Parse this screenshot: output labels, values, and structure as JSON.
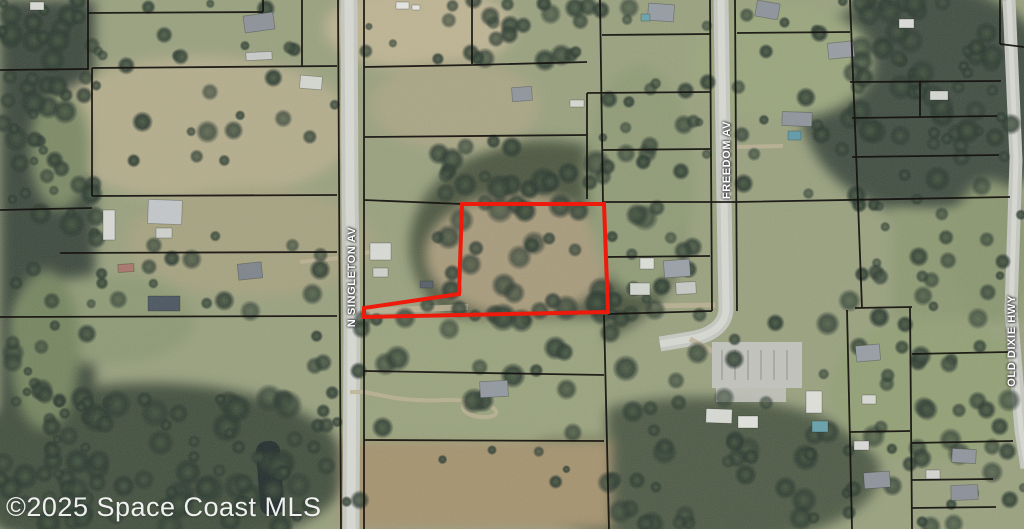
{
  "map": {
    "watermark": "©2025 Space Coast MLS",
    "roads": [
      {
        "name": "N SINGLETON AV",
        "label_x": 352,
        "label_y": 277
      },
      {
        "name": "FREEDOM AV",
        "label_x": 727,
        "label_y": 160
      },
      {
        "name": "OLD DIXIE HWY",
        "label_x": 1012,
        "label_y": 341
      }
    ],
    "colors": {
      "boundary": "#161310",
      "subject_outline": "#ee1a0b",
      "road_fill": "#c6c8c1",
      "road_core": "#d7d9d2",
      "dirt_path": "#bdb294",
      "label_text": "#ffffff",
      "watermark_text": "#ffffff",
      "base_terrain": "#99a17e"
    },
    "subject_parcel": {
      "outline_color": "#ee1a0b",
      "stroke_width": 4,
      "points": [
        [
          462,
          204
        ],
        [
          604,
          204
        ],
        [
          608,
          312
        ],
        [
          364,
          317
        ],
        [
          364,
          308
        ],
        [
          459,
          294
        ]
      ]
    },
    "road_strips": [
      {
        "d": "M349,0 L350,200 L352,330 L351,529",
        "w": 17
      },
      {
        "d": "M721,0 L724,200 L726,308 C726,326 710,336 690,339 L660,344",
        "w": 15
      },
      {
        "d": "M1009,0 L1016,160 L1011,310 L1021,430 L1027,468",
        "w": 13
      }
    ],
    "parcel_lines": [
      "M0,70 L88,69",
      "M88,0 L88,70",
      "M88,13 L263,12",
      "M263,0 L263,12",
      "M0,210 L92,208",
      "M92,68 L337,66",
      "M302,0 L302,66",
      "M92,68 L92,196",
      "M92,196 L337,195",
      "M60,253 L337,252",
      "M0,317 L337,316",
      "M338,0 L341,529",
      "M364,0 L364,529",
      "M364,67 L472,65 L587,62",
      "M472,0 L472,64",
      "M364,137 L587,135",
      "M587,93 L587,199",
      "M587,93 L710,92",
      "M600,0 L603,203",
      "M602,35 L710,34",
      "M602,150 L710,149",
      "M364,200 L462,204",
      "M462,204 L604,203",
      "M604,202 L735,202 L1010,197",
      "M606,257 L710,256",
      "M608,314 L712,311",
      "M604,315 L609,529",
      "M364,371 L604,375",
      "M364,440 L604,441",
      "M710,0 L712,311",
      "M735,0 L737,311",
      "M737,33 L850,32",
      "M850,0 L858,202 L862,308",
      "M847,310 L852,529",
      "M850,82 L1001,81",
      "M920,82 L920,117",
      "M852,118 L997,116",
      "M852,157 L999,155",
      "M1000,0 L1000,44",
      "M1000,44 L1024,47",
      "M855,308 L912,307",
      "M910,307 L912,529",
      "M912,354 L1008,352",
      "M850,432 L910,431",
      "M912,443 L1013,441",
      "M912,480 L993,479",
      "M912,508 L996,507"
    ],
    "fields": [
      [
        "r",
        0,
        0,
        95,
        529,
        "#3d4a3d"
      ],
      [
        "e",
        150,
        468,
        200,
        85,
        "#43503e"
      ],
      [
        "e",
        545,
        245,
        135,
        105,
        "#4b5741"
      ],
      [
        "e",
        930,
        100,
        130,
        115,
        "#404d40"
      ],
      [
        "e",
        700,
        472,
        180,
        75,
        "#4d5a44"
      ],
      [
        "e",
        200,
        128,
        155,
        72,
        "#b4ad8c"
      ],
      [
        "e",
        420,
        28,
        95,
        42,
        "#beb493"
      ],
      [
        "r",
        340,
        438,
        272,
        91,
        "#a5936e"
      ],
      [
        "r",
        337,
        317,
        270,
        122,
        "#9aa37d"
      ],
      [
        "e",
        782,
        62,
        92,
        58,
        "#9aa67d"
      ],
      [
        "e",
        930,
        390,
        100,
        72,
        "#92a074"
      ],
      [
        "e",
        520,
        255,
        95,
        62,
        "#a89b7c"
      ],
      [
        "e",
        640,
        180,
        55,
        115,
        "#909b76"
      ],
      [
        "r",
        892,
        208,
        132,
        112,
        "#8d9972"
      ],
      [
        "e",
        250,
        242,
        125,
        55,
        "#a5a380"
      ],
      [
        "e",
        455,
        105,
        85,
        45,
        "#a9a584"
      ],
      [
        "e",
        105,
        320,
        90,
        45,
        "#8e9a74"
      ],
      [
        "e",
        60,
        150,
        30,
        60,
        "#7c8a65"
      ],
      [
        "e",
        45,
        350,
        35,
        80,
        "#75855f"
      ],
      [
        "e",
        990,
        250,
        40,
        70,
        "#8a9770"
      ]
    ],
    "dirt_paths": [
      [
        "M364,311 L468,307",
        6
      ],
      [
        "M364,253 L372,252 L382,258",
        4
      ],
      [
        "M300,262 L338,258",
        4
      ],
      [
        "M350,392 L364,392 L395,398 C430,403 450,398 468,401",
        4
      ],
      [
        "M468,401 C500,404 505,418 482,417 C462,416 458,404 468,401",
        4
      ],
      [
        "M737,147 L783,146",
        4
      ],
      [
        "M652,306 L715,305",
        5
      ],
      [
        "M690,339 L714,352",
        5
      ]
    ],
    "parking_lot": {
      "x": 712,
      "y": 342,
      "w": 90,
      "h": 46,
      "fill": "#c2c3bd",
      "apron_x": 716,
      "apron_y": 386,
      "apron_w": 70,
      "apron_h": 16,
      "row_color": "#8e8f89"
    },
    "ponds": [
      [
        258,
        441,
        24,
        74,
        -4,
        "#222d2d"
      ]
    ],
    "tree_clusters": [
      [
        0,
        0,
        95,
        529,
        100,
        5,
        14
      ],
      [
        40,
        395,
        260,
        134,
        55,
        6,
        16
      ],
      [
        95,
        0,
        215,
        66,
        12,
        4,
        10
      ],
      [
        95,
        70,
        240,
        120,
        14,
        5,
        12
      ],
      [
        95,
        195,
        245,
        120,
        18,
        5,
        12
      ],
      [
        290,
        317,
        78,
        212,
        16,
        5,
        11
      ],
      [
        365,
        0,
        105,
        65,
        6,
        4,
        9
      ],
      [
        470,
        0,
        120,
        62,
        20,
        6,
        12
      ],
      [
        425,
        140,
        235,
        195,
        60,
        7,
        15
      ],
      [
        600,
        0,
        112,
        200,
        20,
        5,
        11
      ],
      [
        605,
        205,
        105,
        110,
        12,
        5,
        11
      ],
      [
        737,
        0,
        115,
        195,
        16,
        5,
        11
      ],
      [
        848,
        0,
        165,
        205,
        65,
        6,
        14
      ],
      [
        848,
        205,
        176,
        115,
        22,
        5,
        12
      ],
      [
        608,
        315,
        245,
        214,
        45,
        6,
        14
      ],
      [
        848,
        320,
        176,
        209,
        38,
        5,
        13
      ],
      [
        365,
        317,
        235,
        120,
        16,
        6,
        14
      ],
      [
        365,
        440,
        240,
        89,
        5,
        4,
        9
      ]
    ],
    "houses": [
      [
        244,
        14,
        30,
        17,
        -8,
        "#8d9199"
      ],
      [
        246,
        52,
        26,
        8,
        -3,
        "#c9cbc9"
      ],
      [
        300,
        76,
        22,
        13,
        5,
        "#d5d7d1"
      ],
      [
        396,
        2,
        13,
        7,
        0,
        "#e6e6e2"
      ],
      [
        412,
        5,
        8,
        5,
        0,
        "#e6e6e2"
      ],
      [
        30,
        2,
        14,
        8,
        0,
        "#d9d9d5"
      ],
      [
        648,
        4,
        26,
        17,
        4,
        "#969ca4"
      ],
      [
        641,
        14,
        9,
        7,
        0,
        "#69a2ac"
      ],
      [
        756,
        2,
        23,
        16,
        10,
        "#8d939b"
      ],
      [
        828,
        42,
        26,
        16,
        -6,
        "#979ca3"
      ],
      [
        782,
        112,
        30,
        14,
        2,
        "#8f949c"
      ],
      [
        788,
        131,
        13,
        9,
        0,
        "#5f9aa8"
      ],
      [
        930,
        91,
        18,
        9,
        0,
        "#d5d7d2"
      ],
      [
        899,
        19,
        15,
        9,
        0,
        "#dcdcd8"
      ],
      [
        148,
        200,
        34,
        24,
        2,
        "#c3c7c9"
      ],
      [
        156,
        228,
        16,
        10,
        0,
        "#cfd1cd"
      ],
      [
        103,
        210,
        12,
        30,
        0,
        "#d8d8d4"
      ],
      [
        118,
        264,
        16,
        8,
        -4,
        "#a8766a"
      ],
      [
        238,
        263,
        24,
        16,
        -6,
        "#7e848c"
      ],
      [
        148,
        296,
        32,
        15,
        0,
        "#4a5560"
      ],
      [
        370,
        243,
        21,
        17,
        0,
        "#d9dbd5"
      ],
      [
        373,
        268,
        15,
        9,
        0,
        "#cfd1cb"
      ],
      [
        420,
        281,
        13,
        7,
        0,
        "#565e66"
      ],
      [
        512,
        87,
        20,
        14,
        -4,
        "#8f959d"
      ],
      [
        570,
        100,
        14,
        7,
        0,
        "#d8d8d2"
      ],
      [
        480,
        381,
        28,
        16,
        -3,
        "#9298a0"
      ],
      [
        640,
        258,
        14,
        11,
        0,
        "#dddfd9"
      ],
      [
        664,
        260,
        26,
        17,
        -4,
        "#9aa0a8"
      ],
      [
        630,
        283,
        20,
        12,
        0,
        "#d3d5cf"
      ],
      [
        676,
        282,
        20,
        12,
        -3,
        "#c7c9c5"
      ],
      [
        706,
        409,
        26,
        14,
        2,
        "#d8dad4"
      ],
      [
        738,
        416,
        20,
        12,
        0,
        "#e2e2de"
      ],
      [
        806,
        391,
        16,
        22,
        0,
        "#dfe0da"
      ],
      [
        812,
        421,
        16,
        11,
        0,
        "#65a0aa"
      ],
      [
        856,
        345,
        24,
        16,
        -5,
        "#989da5"
      ],
      [
        862,
        395,
        14,
        9,
        0,
        "#d9d9d3"
      ],
      [
        854,
        441,
        15,
        9,
        0,
        "#dadad6"
      ],
      [
        864,
        472,
        26,
        16,
        -4,
        "#8e939b"
      ],
      [
        952,
        449,
        24,
        14,
        3,
        "#90959d"
      ],
      [
        951,
        485,
        27,
        15,
        -2,
        "#8b9099"
      ],
      [
        926,
        470,
        14,
        9,
        0,
        "#d4d4d0"
      ]
    ]
  }
}
